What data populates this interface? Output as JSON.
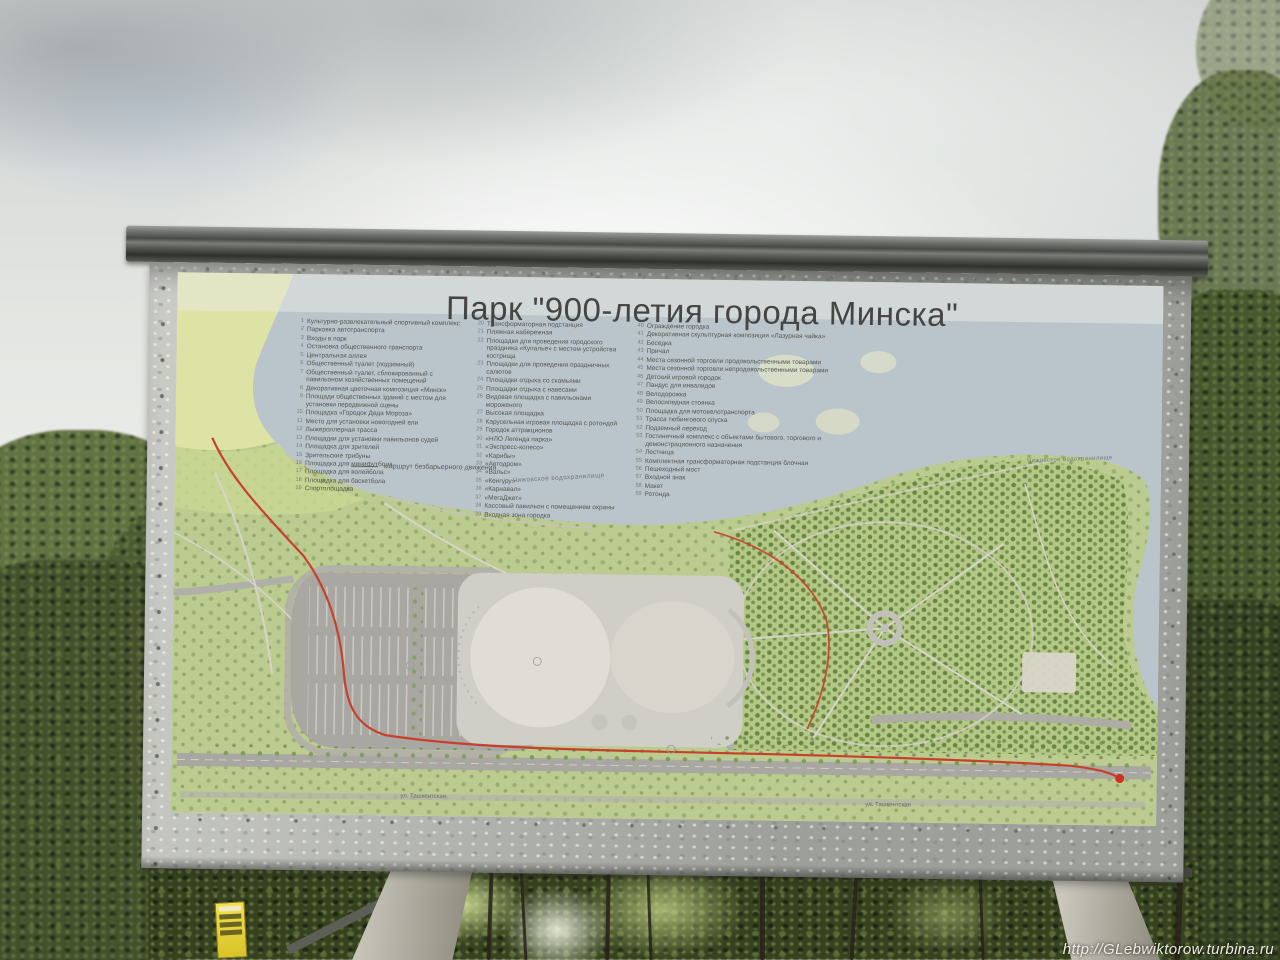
{
  "photo": {
    "watermark": "http://GLebwiktorow.turbina.ru"
  },
  "board": {
    "title": "Парк \"900-летия города Минска\"",
    "legend": {
      "route_note": "маршрут безбарьерного движения",
      "columns": [
        {
          "items": [
            {
              "n": "1",
              "t": "Культурно-развлекательный спортивный комплекс"
            },
            {
              "n": "2",
              "t": "Парковка автотранспорта"
            },
            {
              "n": "3",
              "t": "Входы в парк"
            },
            {
              "n": "4",
              "t": "Остановка общественного транспорта"
            },
            {
              "n": "5",
              "t": "Центральная аллея"
            },
            {
              "n": "6",
              "t": "Общественный туалет (подземный)"
            },
            {
              "n": "7",
              "t": "Общественный туалет, сблокированный с павильоном хозяйственных помещений"
            },
            {
              "n": "8",
              "t": "Декоративная цветочная композиция «Минск»"
            },
            {
              "n": "9",
              "t": "Площади общественных зданий с местом для установки передвижной сцены"
            },
            {
              "n": "10",
              "t": "Площадка «Городок Деда Мороза»"
            },
            {
              "n": "11",
              "t": "Место для установки новогодней ели"
            },
            {
              "n": "12",
              "t": "Лыжероллерная трасса"
            },
            {
              "n": "13",
              "t": "Площадки для установки павильонов судей"
            },
            {
              "n": "14",
              "t": "Площадка для зрителей"
            },
            {
              "n": "15",
              "t": "Зрительские трибуны"
            },
            {
              "n": "16",
              "t": "Площадка для минифутбола"
            },
            {
              "n": "17",
              "t": "Площадка для волейбола"
            },
            {
              "n": "18",
              "t": "Площадка для баскетбола"
            },
            {
              "n": "19",
              "t": "Спортплощадка"
            }
          ]
        },
        {
          "items": [
            {
              "n": "20",
              "t": "Трансформаторная подстанция"
            },
            {
              "n": "21",
              "t": "Пляжная набережная"
            },
            {
              "n": "22",
              "t": "Площадки для проведения городского праздника «Купалье» с местом устройства кострища"
            },
            {
              "n": "23",
              "t": "Площадки для проведения праздничных салютов"
            },
            {
              "n": "24",
              "t": "Площадки отдыха со скамьями"
            },
            {
              "n": "25",
              "t": "Площадки отдыха с навесами"
            },
            {
              "n": "26",
              "t": "Видовая площадка с павильонами мороженого"
            },
            {
              "n": "27",
              "t": "Высокая площадка"
            },
            {
              "n": "28",
              "t": "Карусельная игровая площадка с ротондой"
            },
            {
              "n": "29",
              "t": "Городок аттракционов"
            },
            {
              "n": "30",
              "t": "«НЛО Легенда парка»"
            },
            {
              "n": "31",
              "t": "«Экспресс-колесо»"
            },
            {
              "n": "32",
              "t": "«Карибы»"
            },
            {
              "n": "33",
              "t": "«Автодром»"
            },
            {
              "n": "34",
              "t": "«Вальс»"
            },
            {
              "n": "35",
              "t": "«Кенгуру»"
            },
            {
              "n": "36",
              "t": "«Карнавал»"
            },
            {
              "n": "37",
              "t": "«МегаДжет»"
            },
            {
              "n": "38",
              "t": "Кассовый павильон с помещением охраны"
            },
            {
              "n": "39",
              "t": "Входная зона городка"
            }
          ]
        },
        {
          "items": [
            {
              "n": "40",
              "t": "Ограждение городка"
            },
            {
              "n": "41",
              "t": "Декоративная скульптурная композиция «Лазурная чайка»"
            },
            {
              "n": "42",
              "t": "Беседка"
            },
            {
              "n": "43",
              "t": "Причал"
            },
            {
              "n": "44",
              "t": "Места сезонной торговли продовольственными товарами"
            },
            {
              "n": "45",
              "t": "Места сезонной торговли непродовольственными товарами"
            },
            {
              "n": "46",
              "t": "Детский игровой городок"
            },
            {
              "n": "47",
              "t": "Пандус для инвалидов"
            },
            {
              "n": "48",
              "t": "Велодорожка"
            },
            {
              "n": "49",
              "t": "Велосипедная стоянка"
            },
            {
              "n": "50",
              "t": "Площадка для мотовелотранспорта"
            },
            {
              "n": "51",
              "t": "Трасса тюбингового спуска"
            },
            {
              "n": "52",
              "t": "Подземный переход"
            },
            {
              "n": "53",
              "t": "Гостиничный комплекс с объектами бытового, торгового и демонстрационного назначения"
            },
            {
              "n": "54",
              "t": "Лестница"
            },
            {
              "n": "55",
              "t": "Комплектная трансформаторная подстанция блочная"
            },
            {
              "n": "56",
              "t": "Пешеходный мост"
            },
            {
              "n": "57",
              "t": "Входной знак"
            },
            {
              "n": "58",
              "t": "Макет"
            },
            {
              "n": "59",
              "t": "Ротонда"
            }
          ]
        }
      ]
    },
    "map": {
      "water_label_left": "Чижовское водохранилище",
      "water_label_right": "Чижовское водохранилище",
      "street_label_left": "ул. Ташкентская",
      "street_label_right": "ул. Ташкентская",
      "colors": {
        "water": "#bac5cb",
        "park": "#bccb90",
        "route": "#c8402c"
      }
    }
  }
}
